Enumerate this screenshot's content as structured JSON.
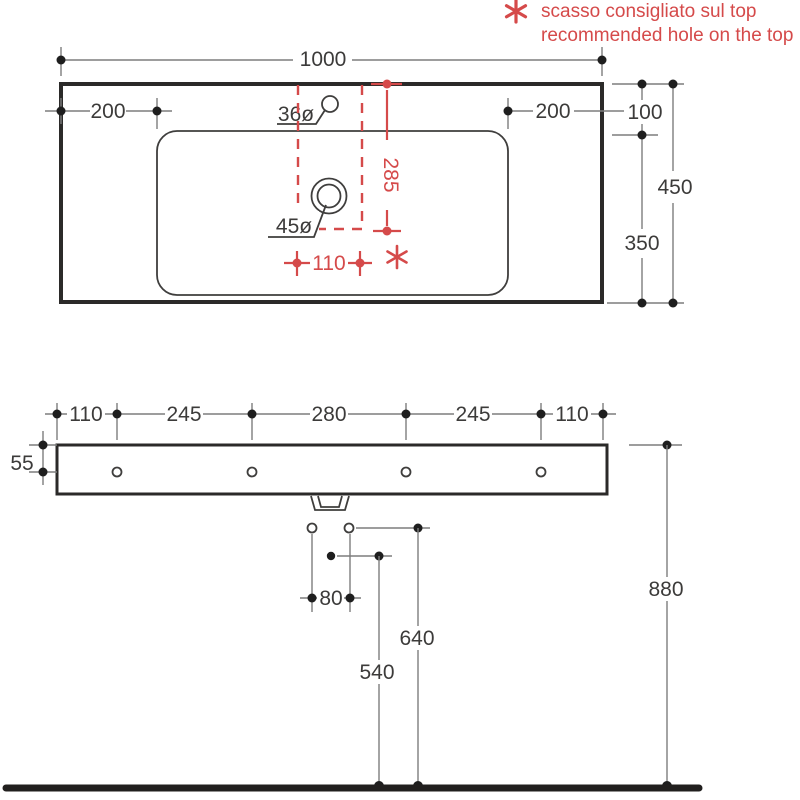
{
  "legend": {
    "symbol": "six-spoke-asterisk",
    "line1": "scasso consigliato sul top",
    "line2": "recommended hole on the top"
  },
  "colors": {
    "accent_red": "#d54a4a",
    "drawing_ink": "#2b2a29",
    "dimension_gray": "#7d7d7d",
    "text_gray": "#3c3b3a"
  },
  "top_view": {
    "overall_width": "1000",
    "left_offset": "200",
    "right_offset": "200",
    "corner_offset": "100",
    "total_depth": "450",
    "drain_depth_offset": "350",
    "tap_hole": "36ø",
    "drain_hole": "45ø",
    "hole_offset_from_top": "285",
    "hole_width": "110"
  },
  "front_view": {
    "spacings": [
      "110",
      "245",
      "280",
      "245",
      "110"
    ],
    "fixing_hole_offset": "55",
    "drain_holes_spacing": "80",
    "siphon_height": "540",
    "drain_height": "640",
    "rim_height": "880"
  }
}
